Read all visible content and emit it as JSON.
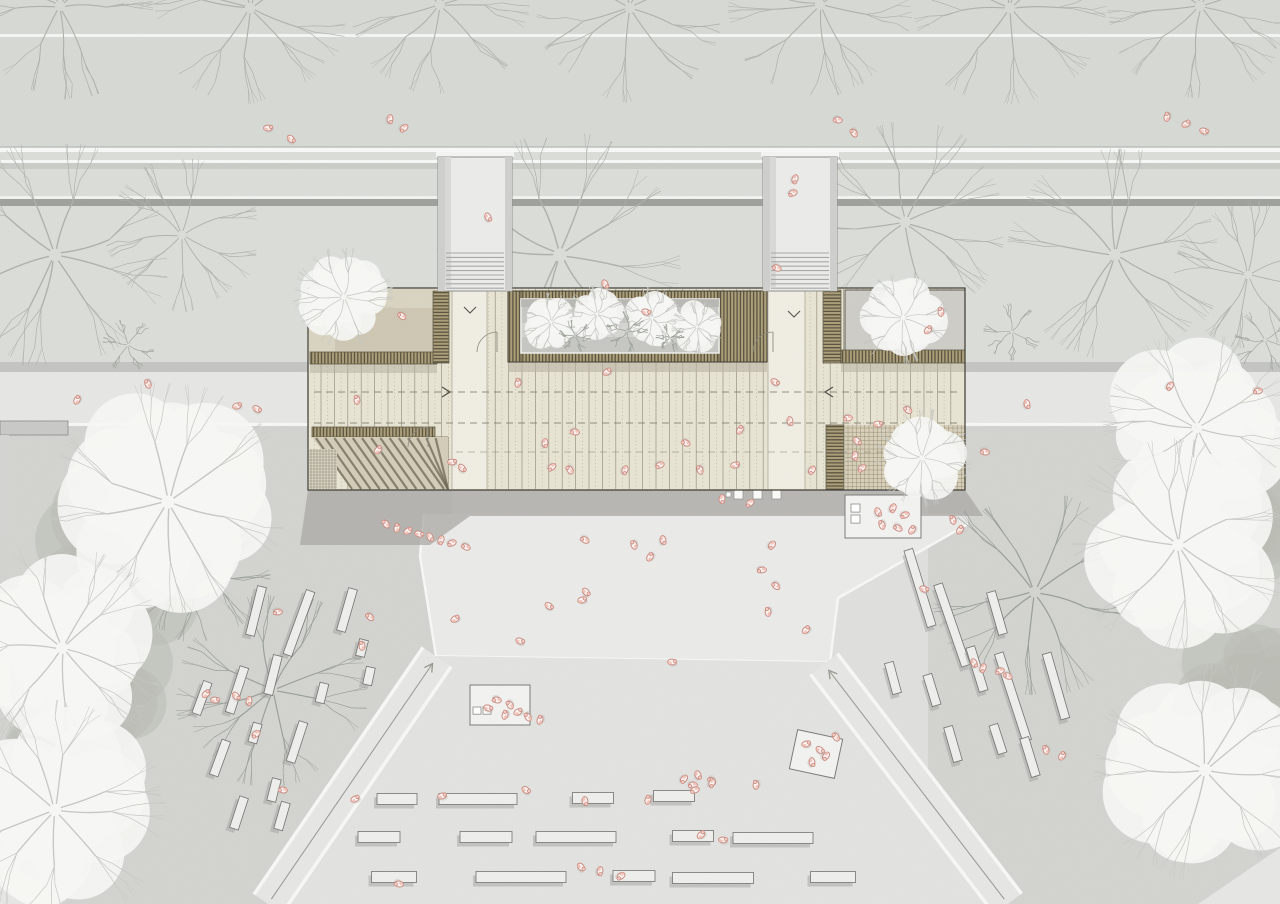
{
  "meta": {
    "title": "architectural-site-plan",
    "canvas_w": 1280,
    "canvas_h": 904
  },
  "palette": {
    "base": "#dfdfdd",
    "plantStrip": "#d7d9d4",
    "road": "#dbddd8",
    "curb": "#c6c8c3",
    "wall": "#9fa19c",
    "path": "#e6e6e4",
    "grass": "#d3d4d0",
    "plaza": "#eaeae8",
    "plazaLow": "#e2e2e0",
    "lineWhite": "#f7f7f5",
    "shadow": "#a7a7a5",
    "shadowDark": "#a9a8a4",
    "deck": "#e8e4d3",
    "deckLine": "#989281",
    "deckDot": "#b8b09c",
    "corridor": "#f0ede3",
    "slatBg": "#ab9e79",
    "slatDark": "#4e4836",
    "slatEdge": "#3f3a2c",
    "terraceL": "#d9d4c1",
    "terraceLShade": "#c9c3ae",
    "terraceR": "#cecdc7",
    "pergola": "#d8d0ba",
    "gridLine": "#978e74",
    "courtyard": "#c6c7c3",
    "outline": "#3b3931",
    "treeWhite": "#f6f6f4",
    "treeDark": "#b9bcb5",
    "branchWhite": "#c6c8c3",
    "branchS1": "#aeb2ab",
    "branchS2": "#999e97",
    "branchBush": "#a4a89f",
    "benchFill": "#eeeeec",
    "benchEdge": "#73736f",
    "benchShadow": "#9b9c98",
    "kioskFill": "#f2f2f0",
    "kioskEdge": "#7c7c78",
    "personStroke": "#c98c82",
    "personFill": "#fdf3f0",
    "personHead": "#f3cdc6",
    "personAccent": "#efb9ae",
    "pathCenter": "#97978f",
    "arrowDark": "#55514a",
    "shaftWall": "#cfcfcd",
    "shaftFloor": "#ebebe9",
    "tread": "#a8a8a6",
    "gridSq": "#8f8a7a"
  },
  "scene": {
    "bands": {
      "topStrip": [
        0,
        0,
        1280,
        152
      ],
      "upperStrip": [
        0,
        0,
        1280,
        36
      ],
      "road": [
        0,
        152,
        1280,
        210
      ],
      "wallSegs": [
        [
          0,
          438
        ],
        [
          512,
          763
        ],
        [
          837,
          1280
        ]
      ],
      "pathBand": [
        0,
        362,
        1280,
        64
      ],
      "grassLeft": [
        0,
        426,
        452,
        478
      ],
      "grassRight": [
        928,
        426,
        352,
        478
      ],
      "wallBlock": [
        0,
        421,
        68,
        14
      ],
      "wallLeg": [
        0,
        435,
        9,
        100
      ],
      "plaza": [
        [
          424,
          514
        ],
        [
          968,
          514
        ],
        [
          968,
          524
        ],
        [
          838,
          598
        ],
        [
          830,
          662
        ],
        [
          436,
          656
        ],
        [
          420,
          556
        ]
      ],
      "bottomPlaza": [
        [
          436,
          656
        ],
        [
          830,
          662
        ],
        [
          1008,
          904
        ],
        [
          268,
          904
        ]
      ],
      "cornerL": [
        [
          0,
          838
        ],
        [
          62,
          904
        ],
        [
          0,
          904
        ]
      ],
      "cornerR": [
        [
          1280,
          848
        ],
        [
          1280,
          904
        ],
        [
          1198,
          904
        ]
      ]
    },
    "pathL": {
      "a": [
        437,
        657
      ],
      "b": [
        268,
        904
      ],
      "w": 34
    },
    "pathR": {
      "a": [
        824,
        664
      ],
      "b": [
        1008,
        904
      ],
      "w": 34
    },
    "building": {
      "bbox": [
        308,
        288,
        657,
        202
      ],
      "corridors": [
        [
          452,
          291,
          35,
          198
        ],
        [
          768,
          291,
          37,
          198
        ]
      ],
      "leftTerrace": [
        309,
        289,
        124,
        63
      ],
      "leftTerraceShade": [
        335,
        308,
        98,
        44
      ],
      "rightTerrace": [
        845,
        290,
        120,
        62
      ],
      "skylight": [
        873,
        300,
        24,
        23
      ],
      "pergola": [
        845,
        425,
        120,
        65
      ],
      "courtyardOuter": [
        508,
        291,
        259,
        71
      ],
      "courtyardInner": [
        521,
        299,
        198,
        54
      ],
      "slats": [
        [
          310,
          352,
          127,
          12,
          "v"
        ],
        [
          433,
          291,
          16,
          72,
          "h"
        ],
        [
          823,
          290,
          18,
          73,
          "h"
        ],
        [
          841,
          350,
          124,
          13,
          "v"
        ],
        [
          826,
          425,
          18,
          65,
          "h"
        ],
        [
          312,
          427,
          123,
          10,
          "v"
        ],
        [
          352,
          479,
          86,
          11,
          "v"
        ],
        [
          432,
          437,
          16,
          53,
          "h"
        ],
        [
          508,
          291,
          259,
          9,
          "v"
        ],
        [
          508,
          353,
          259,
          9,
          "v"
        ],
        [
          508,
          291,
          13,
          71,
          "v"
        ],
        [
          719,
          291,
          48,
          71,
          "v"
        ]
      ],
      "gridSquare": [
        309,
        449,
        28,
        40
      ],
      "amphi": [
        312,
        437,
        136,
        53
      ],
      "shafts": [
        438,
        763
      ],
      "dashedY": [
        392,
        423,
        452
      ],
      "arrowRight": [
        447,
        392
      ],
      "arrowLeft": [
        828,
        392
      ],
      "chevrons": [
        [
          470,
          312
        ],
        [
          794,
          316
        ]
      ],
      "arcs": [
        [
          497,
          352
        ],
        [
          773,
          352
        ],
        [
          428,
          447
        ]
      ],
      "shadow": [
        [
          308,
          490
        ],
        [
          965,
          490
        ],
        [
          983,
          516
        ],
        [
          470,
          516
        ],
        [
          430,
          545
        ],
        [
          300,
          545
        ]
      ]
    },
    "trees": [
      [
        "s1",
        60,
        6,
        85
      ],
      [
        "s1",
        250,
        8,
        88
      ],
      [
        "s1",
        440,
        5,
        82
      ],
      [
        "s1",
        630,
        8,
        86
      ],
      [
        "s1",
        820,
        5,
        84
      ],
      [
        "s1",
        1010,
        8,
        88
      ],
      [
        "s1",
        1200,
        6,
        84
      ],
      [
        "s1",
        55,
        255,
        105
      ],
      [
        "s1",
        182,
        235,
        70
      ],
      [
        "s1",
        560,
        255,
        112
      ],
      [
        "s1",
        905,
        222,
        92
      ],
      [
        "s1",
        1115,
        255,
        98
      ],
      [
        "s1",
        1248,
        275,
        68
      ],
      [
        "b",
        345,
        332,
        28
      ],
      [
        "b",
        497,
        340,
        26
      ],
      [
        "b",
        700,
        332,
        28
      ],
      [
        "b",
        802,
        345,
        24
      ],
      [
        "b",
        1012,
        332,
        26
      ],
      [
        "b",
        1265,
        340,
        28
      ],
      [
        "b",
        128,
        345,
        24
      ],
      [
        "b",
        610,
        345,
        22
      ],
      [
        "d",
        120,
        560,
        90
      ],
      [
        "d",
        90,
        680,
        80
      ],
      [
        "d",
        60,
        800,
        85
      ],
      [
        "d",
        1230,
        520,
        92
      ],
      [
        "d",
        1245,
        700,
        85
      ],
      [
        "s2",
        196,
        566,
        70
      ],
      [
        "s2",
        272,
        690,
        88
      ],
      [
        "s2",
        1035,
        592,
        94
      ],
      [
        "w",
        168,
        502,
        110
      ],
      [
        "w",
        62,
        648,
        98
      ],
      [
        "w",
        55,
        810,
        102
      ],
      [
        "w",
        1197,
        428,
        86
      ],
      [
        "w",
        1178,
        545,
        98
      ],
      [
        "w",
        1205,
        770,
        102
      ]
    ],
    "buildingTrees": [
      [
        "w",
        344,
        297,
        46
      ],
      [
        "w",
        903,
        318,
        42
      ],
      [
        "w",
        922,
        458,
        45
      ],
      [
        "wc",
        551,
        322,
        27
      ],
      [
        "wc",
        597,
        314,
        26
      ],
      [
        "wc",
        652,
        318,
        28
      ],
      [
        "wc",
        697,
        327,
        24
      ],
      [
        "b2",
        575,
        336,
        15
      ],
      [
        "b2",
        627,
        331,
        19
      ],
      [
        "b2",
        670,
        338,
        13
      ]
    ],
    "benchesLeft": [
      [
        256,
        611,
        50,
        14
      ],
      [
        299,
        623,
        68,
        20
      ],
      [
        347,
        610,
        44,
        16
      ],
      [
        273,
        675,
        40,
        14
      ],
      [
        237,
        690,
        48,
        18
      ],
      [
        202,
        698,
        34,
        20
      ],
      [
        322,
        693,
        20,
        14
      ],
      [
        369,
        676,
        18,
        12
      ],
      [
        362,
        648,
        17,
        14
      ],
      [
        255,
        733,
        20,
        16
      ],
      [
        297,
        742,
        42,
        18
      ],
      [
        220,
        758,
        37,
        20
      ],
      [
        274,
        790,
        23,
        14
      ],
      [
        239,
        813,
        33,
        18
      ],
      [
        282,
        816,
        28,
        16
      ]
    ],
    "benchesRight": [
      [
        920,
        588,
        80,
        -17
      ],
      [
        952,
        625,
        86,
        -19
      ],
      [
        997,
        613,
        44,
        -16
      ],
      [
        977,
        669,
        46,
        -17
      ],
      [
        1013,
        697,
        92,
        -18
      ],
      [
        1056,
        686,
        68,
        -16
      ],
      [
        893,
        678,
        32,
        -15
      ],
      [
        932,
        690,
        32,
        -17
      ],
      [
        953,
        744,
        36,
        -16
      ],
      [
        998,
        739,
        30,
        -18
      ],
      [
        1030,
        757,
        40,
        -17
      ]
    ],
    "benchRows": [
      [
        397,
        799,
        40
      ],
      [
        478,
        799,
        78
      ],
      [
        593,
        798,
        41
      ],
      [
        674,
        796,
        41
      ],
      [
        379,
        837,
        42
      ],
      [
        486,
        837,
        52
      ],
      [
        576,
        837,
        80
      ],
      [
        693,
        836,
        41
      ],
      [
        773,
        838,
        80
      ],
      [
        394,
        877,
        45
      ],
      [
        521,
        877,
        90
      ],
      [
        634,
        876,
        42
      ],
      [
        713,
        878,
        81
      ],
      [
        833,
        877,
        45
      ]
    ],
    "kiosks": {
      "a": {
        "rect": [
          470,
          685,
          60,
          40
        ],
        "squares": [
          [
            473,
            707,
            8
          ],
          [
            483,
            707,
            8
          ]
        ]
      },
      "b": {
        "rect": [
          845,
          495,
          76,
          43
        ],
        "squares": [
          [
            851,
            504,
            9
          ],
          [
            851,
            515,
            9
          ]
        ]
      },
      "c": {
        "x": 816,
        "y": 754,
        "w": 46,
        "h": 40,
        "rot": 12
      }
    },
    "squares": [
      [
        734,
        490,
        9
      ],
      [
        753,
        490,
        9
      ],
      [
        772,
        490,
        9
      ],
      [
        726,
        492,
        5
      ]
    ],
    "people": [
      [
        268,
        128
      ],
      [
        291,
        139
      ],
      [
        390,
        119
      ],
      [
        404,
        128
      ],
      [
        838,
        120
      ],
      [
        854,
        133
      ],
      [
        1167,
        117
      ],
      [
        1186,
        124
      ],
      [
        1204,
        131
      ],
      [
        488,
        217
      ],
      [
        795,
        179
      ],
      [
        793,
        193
      ],
      [
        777,
        268
      ],
      [
        148,
        384
      ],
      [
        77,
        400
      ],
      [
        237,
        406
      ],
      [
        257,
        409
      ],
      [
        1027,
        404
      ],
      [
        1170,
        386
      ],
      [
        1258,
        391
      ],
      [
        402,
        316
      ],
      [
        357,
        400
      ],
      [
        378,
        450
      ],
      [
        452,
        462
      ],
      [
        462,
        468
      ],
      [
        545,
        443
      ],
      [
        552,
        467
      ],
      [
        575,
        432
      ],
      [
        570,
        470
      ],
      [
        518,
        383
      ],
      [
        607,
        372
      ],
      [
        646,
        312
      ],
      [
        605,
        284
      ],
      [
        625,
        470
      ],
      [
        660,
        465
      ],
      [
        686,
        443
      ],
      [
        700,
        470
      ],
      [
        740,
        430
      ],
      [
        735,
        465
      ],
      [
        775,
        382
      ],
      [
        790,
        421
      ],
      [
        812,
        470
      ],
      [
        848,
        418
      ],
      [
        908,
        410
      ],
      [
        941,
        312
      ],
      [
        928,
        330
      ],
      [
        878,
        424
      ],
      [
        857,
        441
      ],
      [
        855,
        456
      ],
      [
        862,
        468
      ],
      [
        985,
        452
      ],
      [
        386,
        524
      ],
      [
        397,
        528
      ],
      [
        408,
        531
      ],
      [
        419,
        534
      ],
      [
        430,
        537
      ],
      [
        441,
        540
      ],
      [
        452,
        543
      ],
      [
        466,
        547
      ],
      [
        634,
        545
      ],
      [
        650,
        557
      ],
      [
        582,
        600
      ],
      [
        549,
        606
      ],
      [
        663,
        540
      ],
      [
        772,
        545
      ],
      [
        762,
        570
      ],
      [
        776,
        586
      ],
      [
        768,
        612
      ],
      [
        806,
        630
      ],
      [
        672,
        662
      ],
      [
        586,
        592
      ],
      [
        722,
        499
      ],
      [
        750,
        503
      ],
      [
        497,
        700
      ],
      [
        510,
        705
      ],
      [
        505,
        715
      ],
      [
        518,
        712
      ],
      [
        488,
        708
      ],
      [
        878,
        512
      ],
      [
        893,
        508
      ],
      [
        905,
        515
      ],
      [
        898,
        528
      ],
      [
        882,
        525
      ],
      [
        912,
        530
      ],
      [
        806,
        744
      ],
      [
        820,
        750
      ],
      [
        812,
        762
      ],
      [
        826,
        756
      ],
      [
        278,
        612
      ],
      [
        370,
        617
      ],
      [
        362,
        646
      ],
      [
        206,
        694
      ],
      [
        215,
        700
      ],
      [
        236,
        696
      ],
      [
        249,
        701
      ],
      [
        256,
        734
      ],
      [
        283,
        790
      ],
      [
        528,
        717
      ],
      [
        540,
        720
      ],
      [
        455,
        619
      ],
      [
        924,
        589
      ],
      [
        974,
        663
      ],
      [
        983,
        668
      ],
      [
        1000,
        671
      ],
      [
        1008,
        676
      ],
      [
        1046,
        750
      ],
      [
        1062,
        756
      ],
      [
        442,
        796
      ],
      [
        526,
        790
      ],
      [
        585,
        801
      ],
      [
        684,
        779
      ],
      [
        693,
        785
      ],
      [
        712,
        781
      ],
      [
        756,
        785
      ],
      [
        701,
        835
      ],
      [
        723,
        840
      ],
      [
        581,
        867
      ],
      [
        600,
        871
      ],
      [
        621,
        876
      ],
      [
        399,
        884
      ],
      [
        836,
        737
      ],
      [
        648,
        800
      ],
      [
        355,
        799
      ],
      [
        520,
        641
      ],
      [
        698,
        775
      ],
      [
        712,
        783
      ],
      [
        695,
        790
      ],
      [
        585,
        540
      ],
      [
        953,
        520
      ],
      [
        960,
        530
      ]
    ]
  }
}
